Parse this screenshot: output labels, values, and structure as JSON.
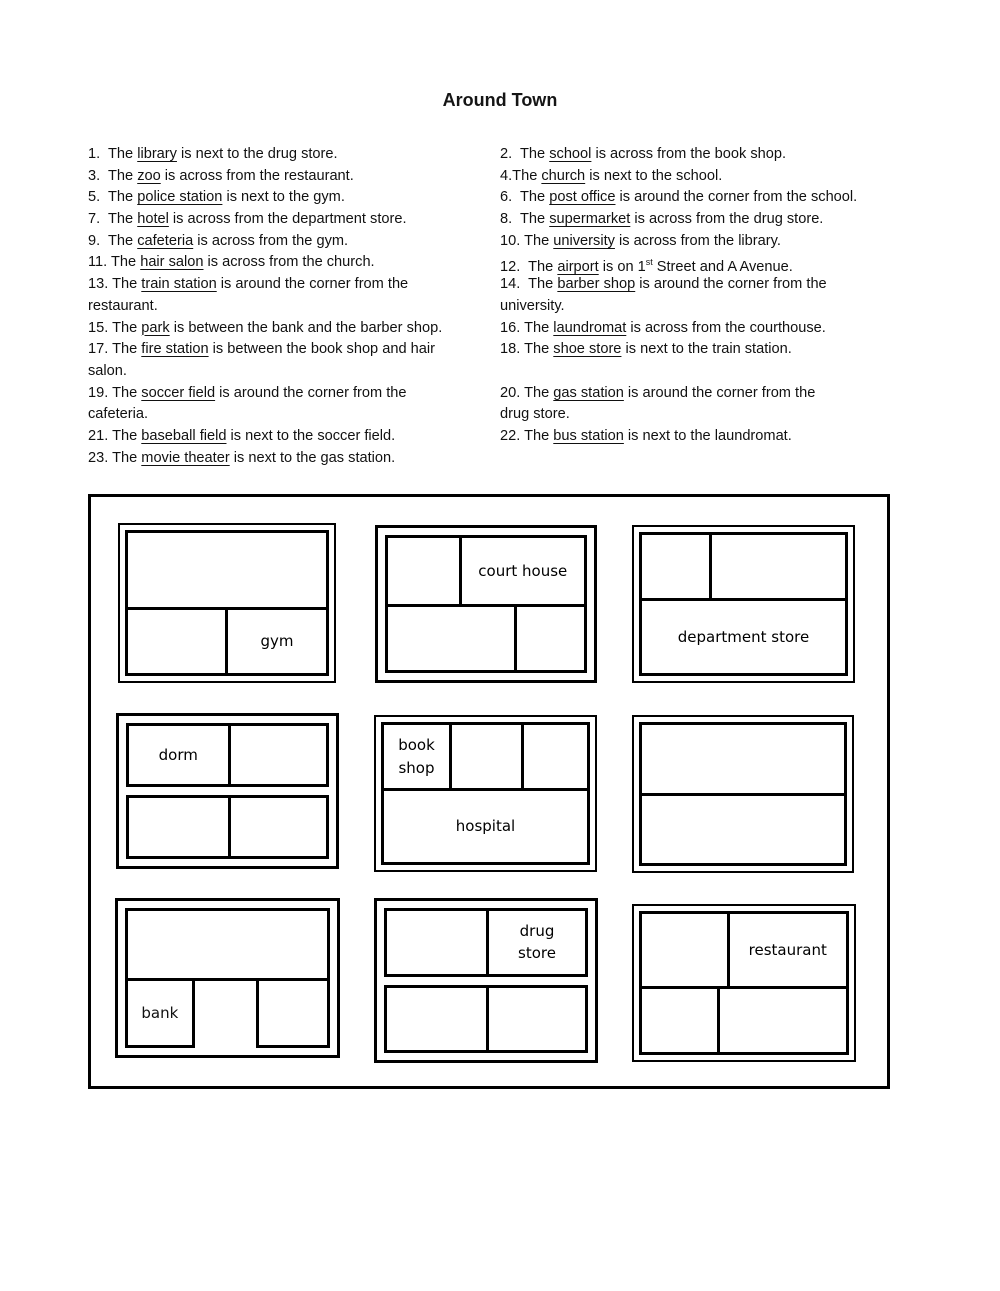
{
  "page": {
    "title": "Around Town"
  },
  "exercise": {
    "rows": [
      {
        "left": [
          [
            {
              "t": "1.  The "
            },
            {
              "t": "library",
              "u": true
            },
            {
              "t": " is next to the drug store."
            }
          ]
        ],
        "right": [
          [
            {
              "t": "2.  The "
            },
            {
              "t": "school",
              "u": true
            },
            {
              "t": " is across from the book shop."
            }
          ]
        ]
      },
      {
        "left": [
          [
            {
              "t": "3.  The "
            },
            {
              "t": "zoo",
              "u": true
            },
            {
              "t": " is across from the restaurant."
            }
          ]
        ],
        "right": [
          [
            {
              "t": "4.The "
            },
            {
              "t": "church",
              "u": true
            },
            {
              "t": " is next to the school."
            }
          ]
        ]
      },
      {
        "left": [
          [
            {
              "t": "5.  The "
            },
            {
              "t": "police station",
              "u": true
            },
            {
              "t": " is next to the gym."
            }
          ]
        ],
        "right": [
          [
            {
              "t": "6.  The "
            },
            {
              "t": "post office",
              "u": true
            },
            {
              "t": " is around the corner from the school."
            }
          ]
        ]
      },
      {
        "left": [
          [
            {
              "t": "7.  The "
            },
            {
              "t": "hotel",
              "u": true
            },
            {
              "t": " is across from the department store."
            }
          ]
        ],
        "right": [
          [
            {
              "t": "8.  The "
            },
            {
              "t": "supermarket",
              "u": true
            },
            {
              "t": " is across from the drug store."
            }
          ]
        ]
      },
      {
        "left": [
          [
            {
              "t": "9.  The "
            },
            {
              "t": "cafeteria",
              "u": true
            },
            {
              "t": " is across from the gym."
            }
          ]
        ],
        "right": [
          [
            {
              "t": "10. The "
            },
            {
              "t": "university",
              "u": true
            },
            {
              "t": " is across from the library."
            }
          ]
        ]
      },
      {
        "left": [
          [
            {
              "t": "11. The "
            },
            {
              "t": "hair salon",
              "u": true
            },
            {
              "t": " is across from the church."
            }
          ]
        ],
        "right": [
          [
            {
              "t": "12.  The "
            },
            {
              "t": "airport",
              "u": true
            },
            {
              "t": " is on 1"
            },
            {
              "t": "st",
              "sup": true
            },
            {
              "t": " Street and A Avenue."
            }
          ]
        ]
      },
      {
        "left": [
          [
            {
              "t": "13. The "
            },
            {
              "t": "train station",
              "u": true
            },
            {
              "t": " is around the corner from the"
            }
          ],
          [
            {
              "t": "restaurant."
            }
          ]
        ],
        "right": [
          [
            {
              "t": "14.  The "
            },
            {
              "t": "barber shop",
              "u": true
            },
            {
              "t": " is around the corner from the"
            }
          ],
          [
            {
              "t": "university."
            }
          ]
        ]
      },
      {
        "left": [
          [
            {
              "t": "15. The "
            },
            {
              "t": "park",
              "u": true
            },
            {
              "t": " is between the bank and the barber shop."
            }
          ]
        ],
        "right": [
          [
            {
              "t": "16. The "
            },
            {
              "t": "laundromat",
              "u": true
            },
            {
              "t": " is across from the courthouse."
            }
          ]
        ]
      },
      {
        "left": [
          [
            {
              "t": "17. The "
            },
            {
              "t": "fire station",
              "u": true
            },
            {
              "t": " is between the book shop and hair"
            }
          ],
          [
            {
              "t": "salon."
            }
          ]
        ],
        "right": [
          [
            {
              "t": "18. The "
            },
            {
              "t": "shoe store",
              "u": true
            },
            {
              "t": " is next to the train station."
            }
          ]
        ]
      },
      {
        "left": [
          [
            {
              "t": "19. The "
            },
            {
              "t": "soccer field",
              "u": true
            },
            {
              "t": " is around the corner from the"
            }
          ],
          [
            {
              "t": "cafeteria."
            }
          ]
        ],
        "right": [
          [
            {
              "t": "20. The "
            },
            {
              "t": "gas station",
              "u": true
            },
            {
              "t": " is around the corner from the"
            }
          ],
          [
            {
              "t": "drug store."
            }
          ]
        ]
      },
      {
        "left": [
          [
            {
              "t": "21. The "
            },
            {
              "t": "baseball field",
              "u": true
            },
            {
              "t": " is next to the soccer field."
            }
          ]
        ],
        "right": [
          [
            {
              "t": "22. The "
            },
            {
              "t": "bus station",
              "u": true
            },
            {
              "t": " is next to the laundromat."
            }
          ]
        ]
      },
      {
        "left": [
          [
            {
              "t": "23. The "
            },
            {
              "t": "movie theater",
              "u": true
            },
            {
              "t": " is next to the gas station."
            }
          ]
        ],
        "right": []
      }
    ]
  },
  "map_labels": {
    "gym": "gym",
    "court_house": "court house",
    "department_store": "department store",
    "dorm": "dorm",
    "book_shop": "book shop",
    "hospital": "hospital",
    "bank": "bank",
    "drug_store": "drug store",
    "restaurant": "restaurant"
  }
}
